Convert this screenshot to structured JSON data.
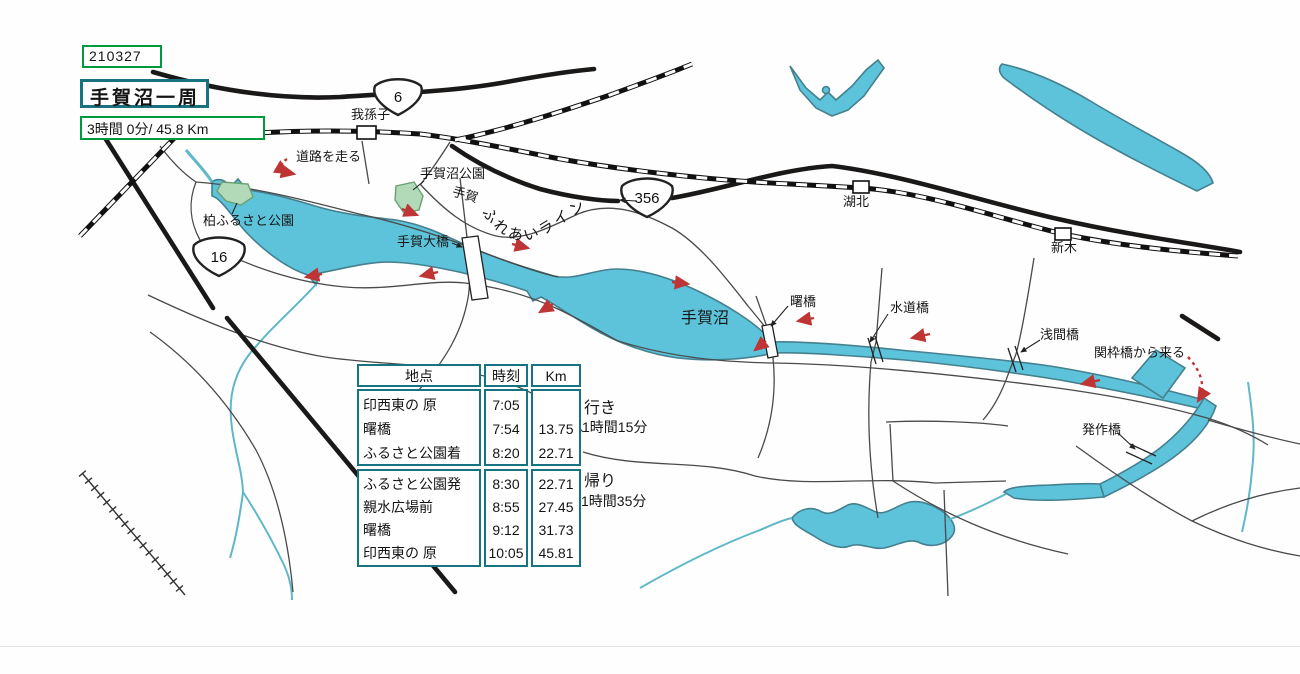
{
  "header": {
    "date": "210327",
    "title": "手賀沼一周",
    "summary": "3時間 0分/ 45.8 Km"
  },
  "annotations": {
    "outbound_label": "行き",
    "outbound_time": "1時間15分",
    "return_label": "帰り",
    "return_time": "1時間35分"
  },
  "map": {
    "labels": {
      "road_note": "道路を走る",
      "teganuma_park": "手賀沼公園",
      "tega": "手賀",
      "fureai_line": "ふれあいライン",
      "kashiwa_furusato_park": "柏ふるさと公園",
      "tega_ohashi": "手賀大橋",
      "teganuma": "手賀沼",
      "akebono_bridge": "曙橋",
      "suido_bridge": "水道橋",
      "sengen_bridge": "浅間橋",
      "sekiwaku_note": "関枠橋から来る",
      "hossaku_bridge": "発作橋",
      "abiko_station": "我孫子",
      "kohoku_station": "湖北",
      "araki_station": "新木"
    },
    "route_shields": [
      {
        "number": "6"
      },
      {
        "number": "356"
      },
      {
        "number": "16"
      }
    ]
  },
  "table": {
    "headers": [
      "地点",
      "時刻",
      "Km"
    ],
    "outbound_rows": [
      {
        "point": "印西東の 原",
        "time": "7:05",
        "km": ""
      },
      {
        "point": "曙橋",
        "time": "7:54",
        "km": "13.75"
      },
      {
        "point": "ふるさと公園着",
        "time": "8:20",
        "km": "22.71"
      }
    ],
    "return_rows": [
      {
        "point": "ふるさと公園発",
        "time": "8:30",
        "km": "22.71"
      },
      {
        "point": "親水広場前",
        "time": "8:55",
        "km": "27.45"
      },
      {
        "point": "曙橋",
        "time": "9:12",
        "km": "31.73"
      },
      {
        "point": "印西東の 原",
        "time": "10:05",
        "km": "45.81"
      }
    ]
  },
  "colors": {
    "water_fill": "#5cc3da",
    "water_outline": "#45808f",
    "stream": "#5fb7c9",
    "thin_road": "#4a4a4a",
    "thick_road": "#1b1818",
    "railway": "#111111",
    "teal_border": "#16737f",
    "green_border": "#009a3e",
    "route_arrow_red": "#bf3434",
    "park_green": "#b2d9b8"
  }
}
